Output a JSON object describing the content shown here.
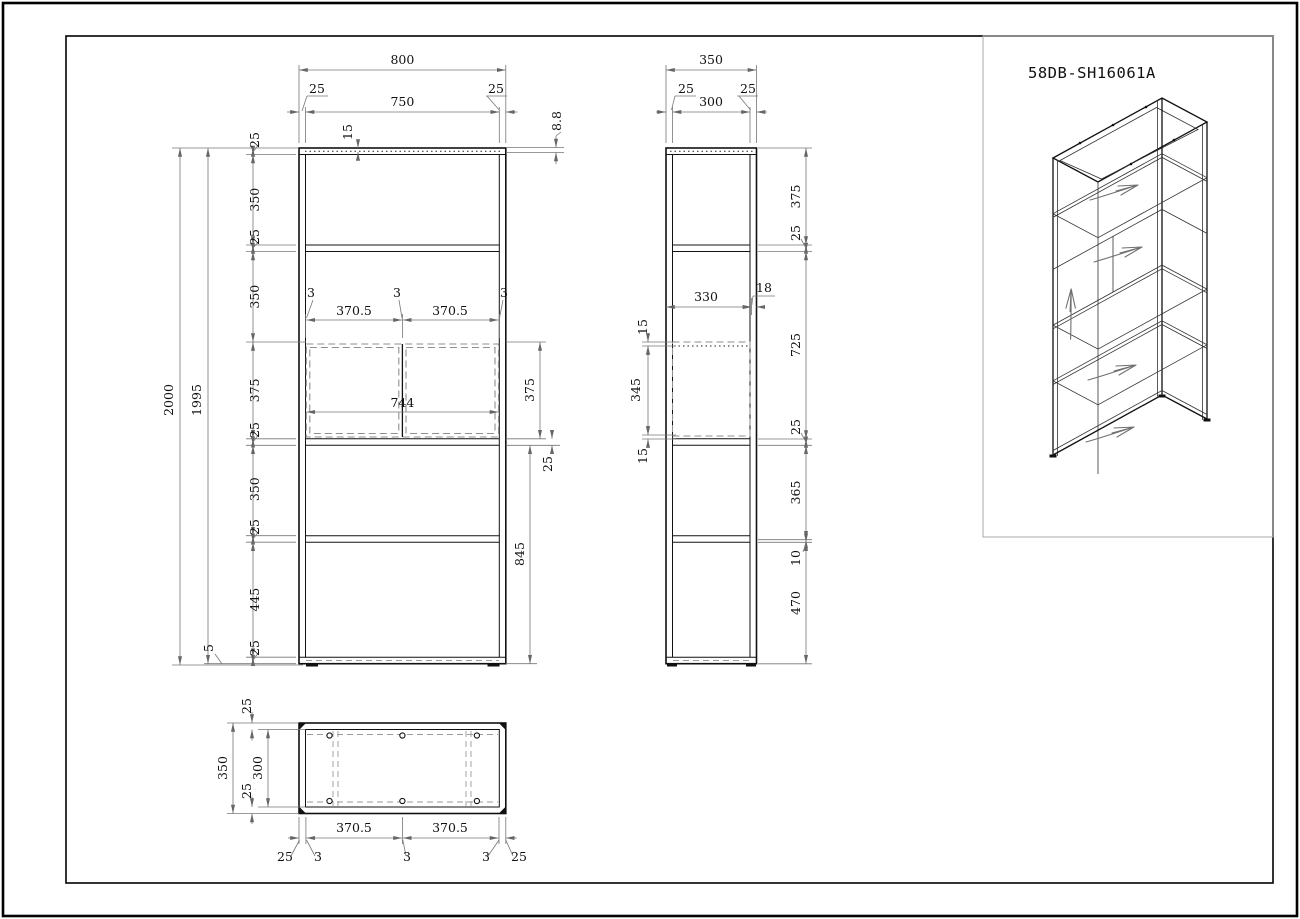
{
  "sheet": {
    "part_number": "58DB-SH16061A"
  },
  "views": {
    "front": {
      "top": {
        "overall": "800",
        "inset_l": "25",
        "inner": "750",
        "inset_r": "25",
        "panel": "15",
        "lip": "8.8"
      },
      "left_chain": [
        "25",
        "350",
        "25",
        "350",
        "375",
        "25",
        "350",
        "25",
        "445",
        "25"
      ],
      "height": {
        "frame": "1995",
        "overall": "2000",
        "foot": "5"
      },
      "doors": {
        "gap_l": "3",
        "w1": "370.5",
        "gap_m": "3",
        "w2": "370.5",
        "gap_r": "3",
        "span": "744",
        "height": "375"
      },
      "right": {
        "shelf": "25",
        "lower": "845"
      }
    },
    "side": {
      "top": {
        "overall": "350",
        "inset_l": "25",
        "inner": "300",
        "inset_r": "25"
      },
      "right_chain": [
        "375",
        "25",
        "725",
        "25",
        "365",
        "10",
        "470"
      ],
      "door": {
        "depth": "330",
        "front_gap": "18",
        "top_gap": "15",
        "panel": "345",
        "bottom_gap": "15"
      }
    },
    "top": {
      "left": {
        "inset_t": "25",
        "overall": "350",
        "inner": "300",
        "inset_b": "25"
      },
      "bottom_chain": [
        "25",
        "3",
        "370.5",
        "3",
        "370.5",
        "3",
        "25"
      ]
    }
  }
}
